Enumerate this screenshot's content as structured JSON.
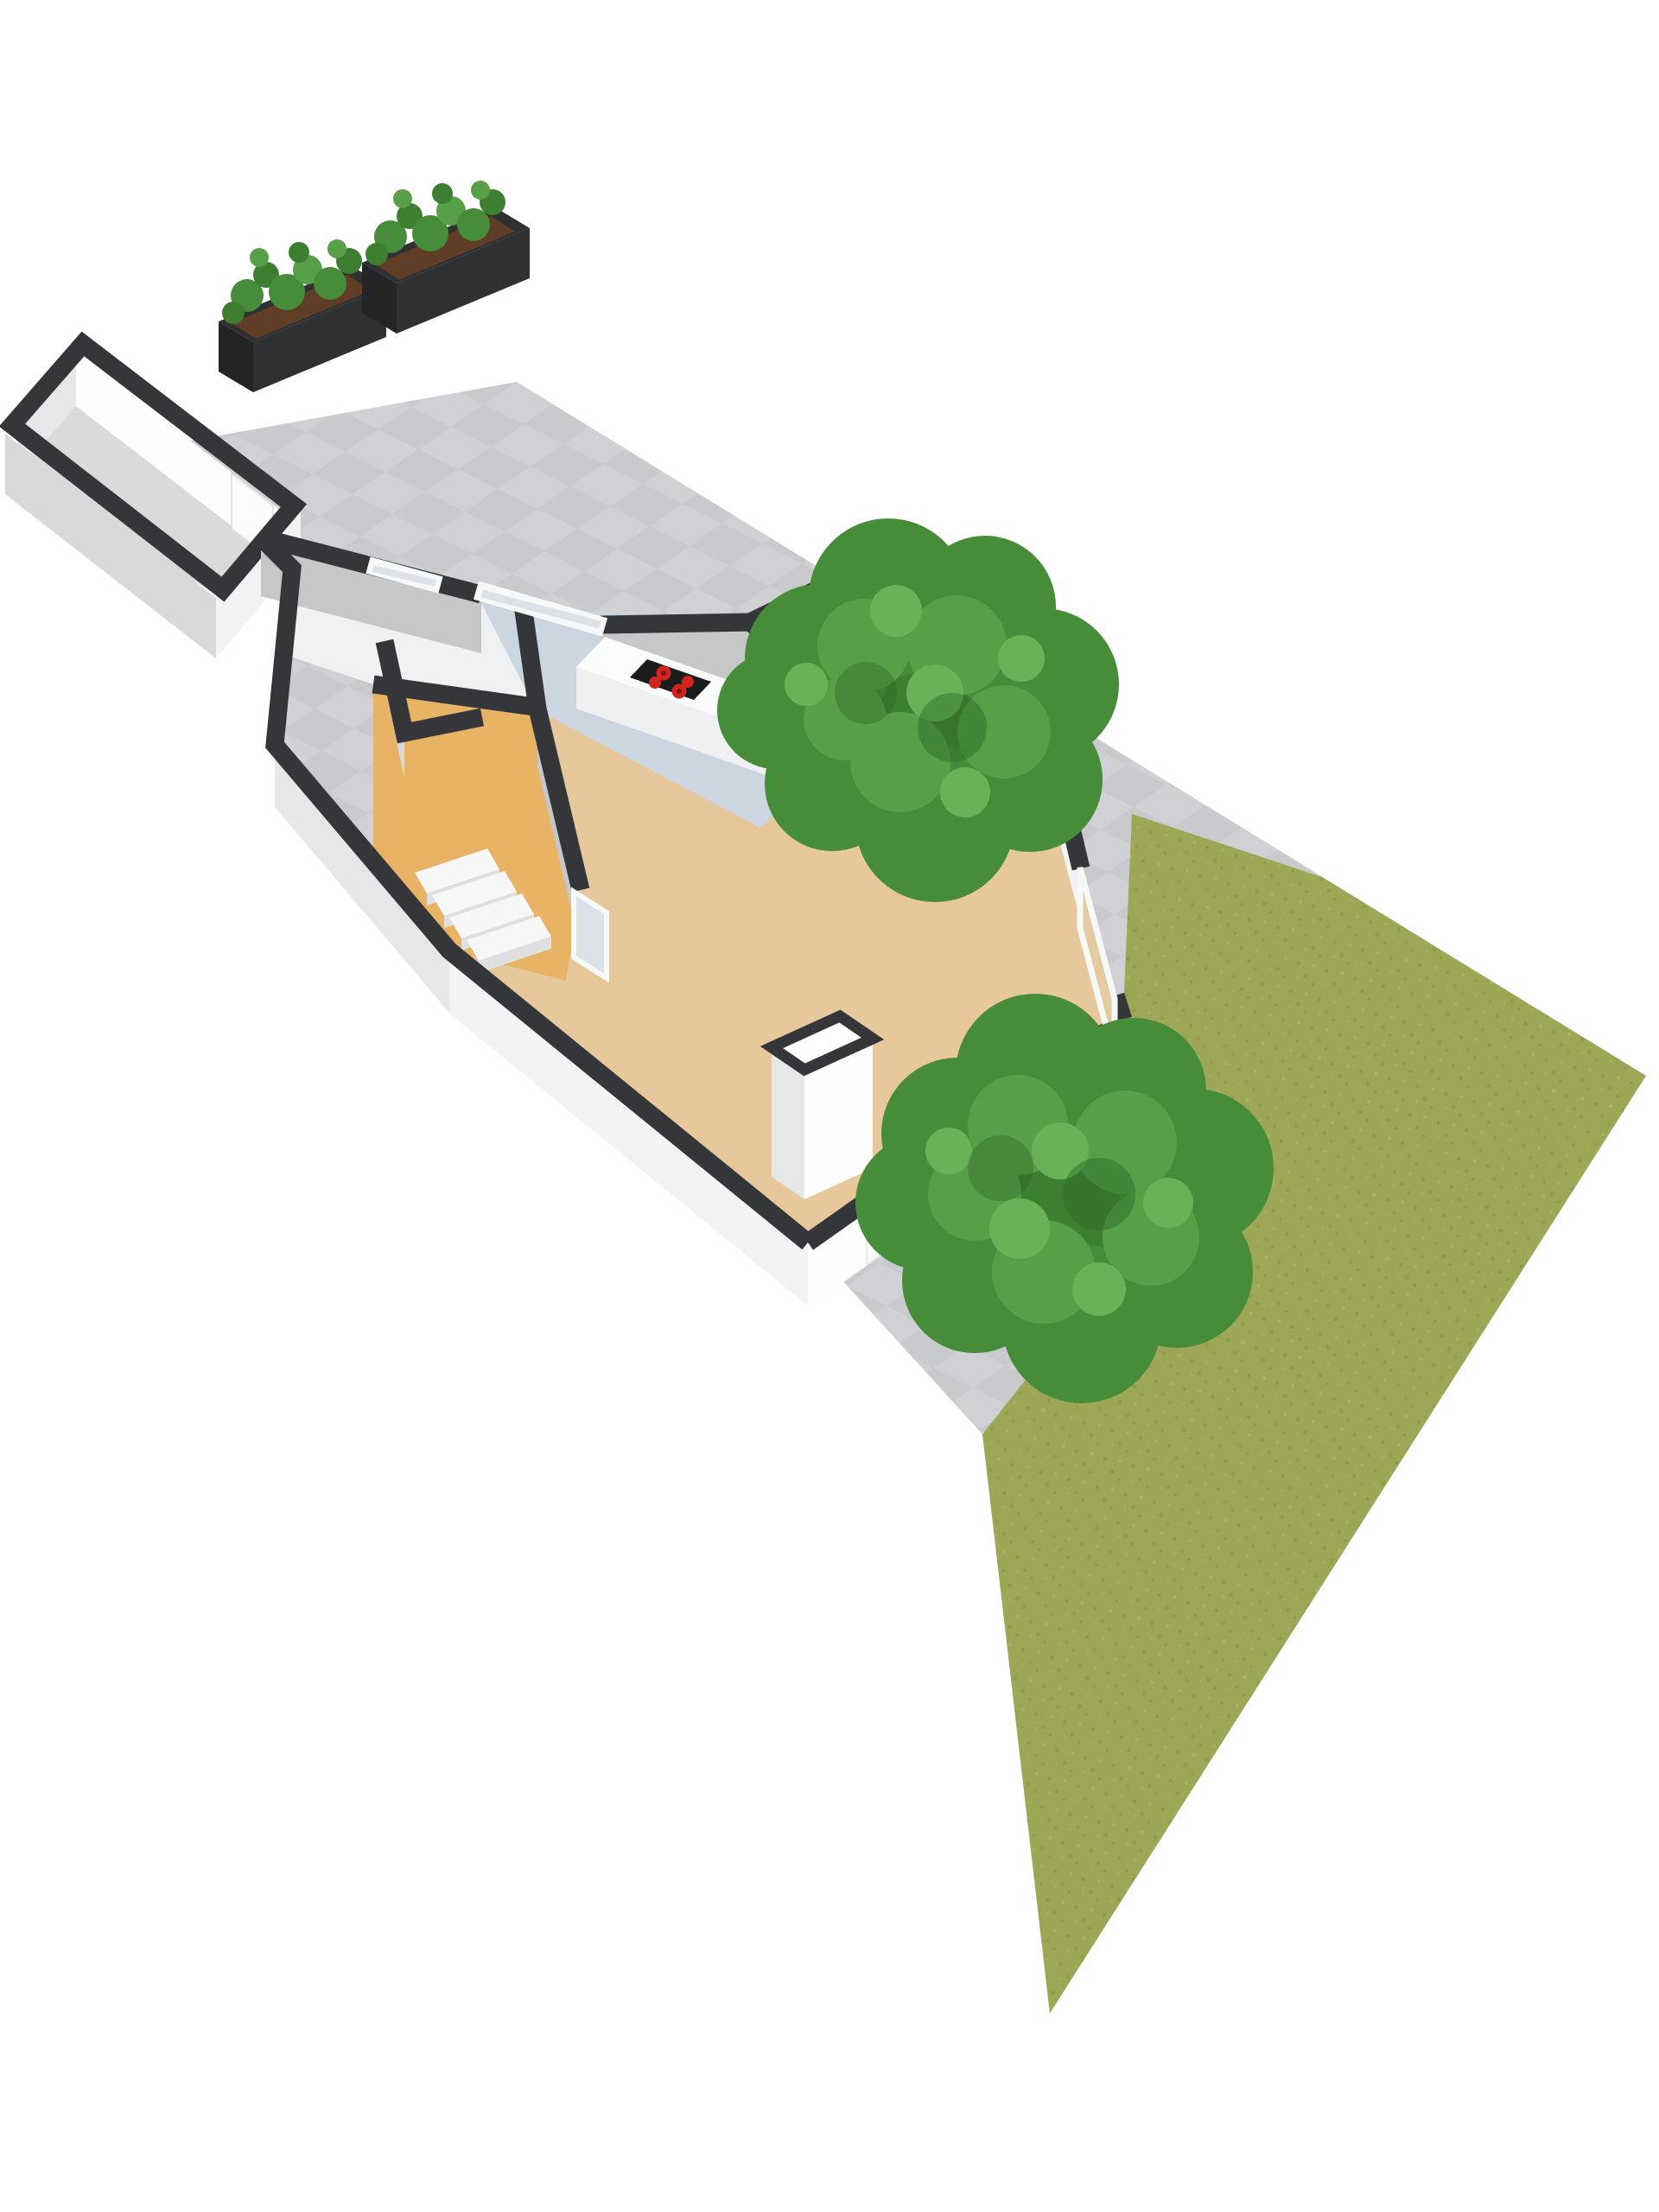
{
  "meta": {
    "type": "3d-floorplan-render",
    "view": "axonometric-top-down",
    "background": "#ffffff"
  },
  "palette": {
    "bg": "#ffffff",
    "paving": "#c8cacd",
    "pavingLight": "#cfd1d4",
    "wallTop": "#343639",
    "wallBright": "#fdfdfe",
    "wallSoft": "#f2f3f4",
    "wallMid": "#e6e7e9",
    "wallShade": "#d8d9db",
    "wallInner": "#c5c7c9",
    "floorWhite": "#f0f1f2",
    "floorGray": "#cfd1d3",
    "floorShed": "#d9dadc",
    "floorKitchen": "#ccd6e1",
    "floorHall": "#e9b366",
    "floorLiving": "#e6c89c",
    "counterTop": "#fafbfb",
    "counterFront": "#eff0f1",
    "counterEnd": "#e6e7e9",
    "cooktop": "#1b1c1e",
    "burner": "#d1241f",
    "burnerCore": "#7e1513",
    "sinkSteel": "#cfd3d6",
    "sinkBasin": "#b9bfc2",
    "sinkLine": "#9fa5a8",
    "glassCool": "#dce2e7",
    "glassTan": "#e3cba2",
    "doorWhite": "#fbfbfc",
    "frameWhite": "#f7f8f8",
    "planterBox": "#2e3032",
    "planterBoxDark": "#222426",
    "planterSoil": "#5f3d26",
    "green1": "#478c39",
    "green2": "#3e7e31",
    "green3": "#57a047",
    "green4": "#69b258",
    "greenDark": "#2f6527",
    "grass": "#9da755",
    "grassD1": "#8f9a4e",
    "grassD2": "#929d50",
    "grassL1": "#a9b260",
    "grassL2": "#a4ad5c",
    "stepTread": "#f7f7f8",
    "stepRiser": "#dfe0e2"
  },
  "scene": {
    "terrace": {
      "surface": "gray-tiles",
      "planter_count": 2,
      "planters": [
        {
          "name": "planter-left",
          "contents": "green-shrubs",
          "soil": "brown"
        },
        {
          "name": "planter-right",
          "contents": "green-shrubs",
          "soil": "brown"
        }
      ]
    },
    "outbuilding": {
      "name": "shed",
      "floor": "floorShed",
      "door_count": 1
    },
    "house": {
      "rooms": [
        {
          "name": "storage-rooms",
          "floor": "floorWhite",
          "windows": 1
        },
        {
          "name": "hallway",
          "floor": "floorHall",
          "fixtures": [
            "staircase",
            "glass-door"
          ]
        },
        {
          "name": "kitchen",
          "floor": "floorKitchen",
          "fixtures": [
            "counter",
            "cooktop",
            "sink",
            "window"
          ]
        },
        {
          "name": "utility-room",
          "floor": "floorGray",
          "fixtures": [
            "sliding-glass-doors"
          ]
        },
        {
          "name": "living-room",
          "floor": "floorLiving",
          "fixtures": [
            "chimney-block",
            "front-door",
            "front-window",
            "side-window"
          ]
        }
      ],
      "cooktop_burners": 4,
      "stair_steps": 4
    },
    "garden": {
      "grass": true,
      "tree_count": 2,
      "trees": [
        {
          "name": "tree-upper"
        },
        {
          "name": "tree-lower"
        }
      ],
      "path": "gray-paving"
    }
  }
}
